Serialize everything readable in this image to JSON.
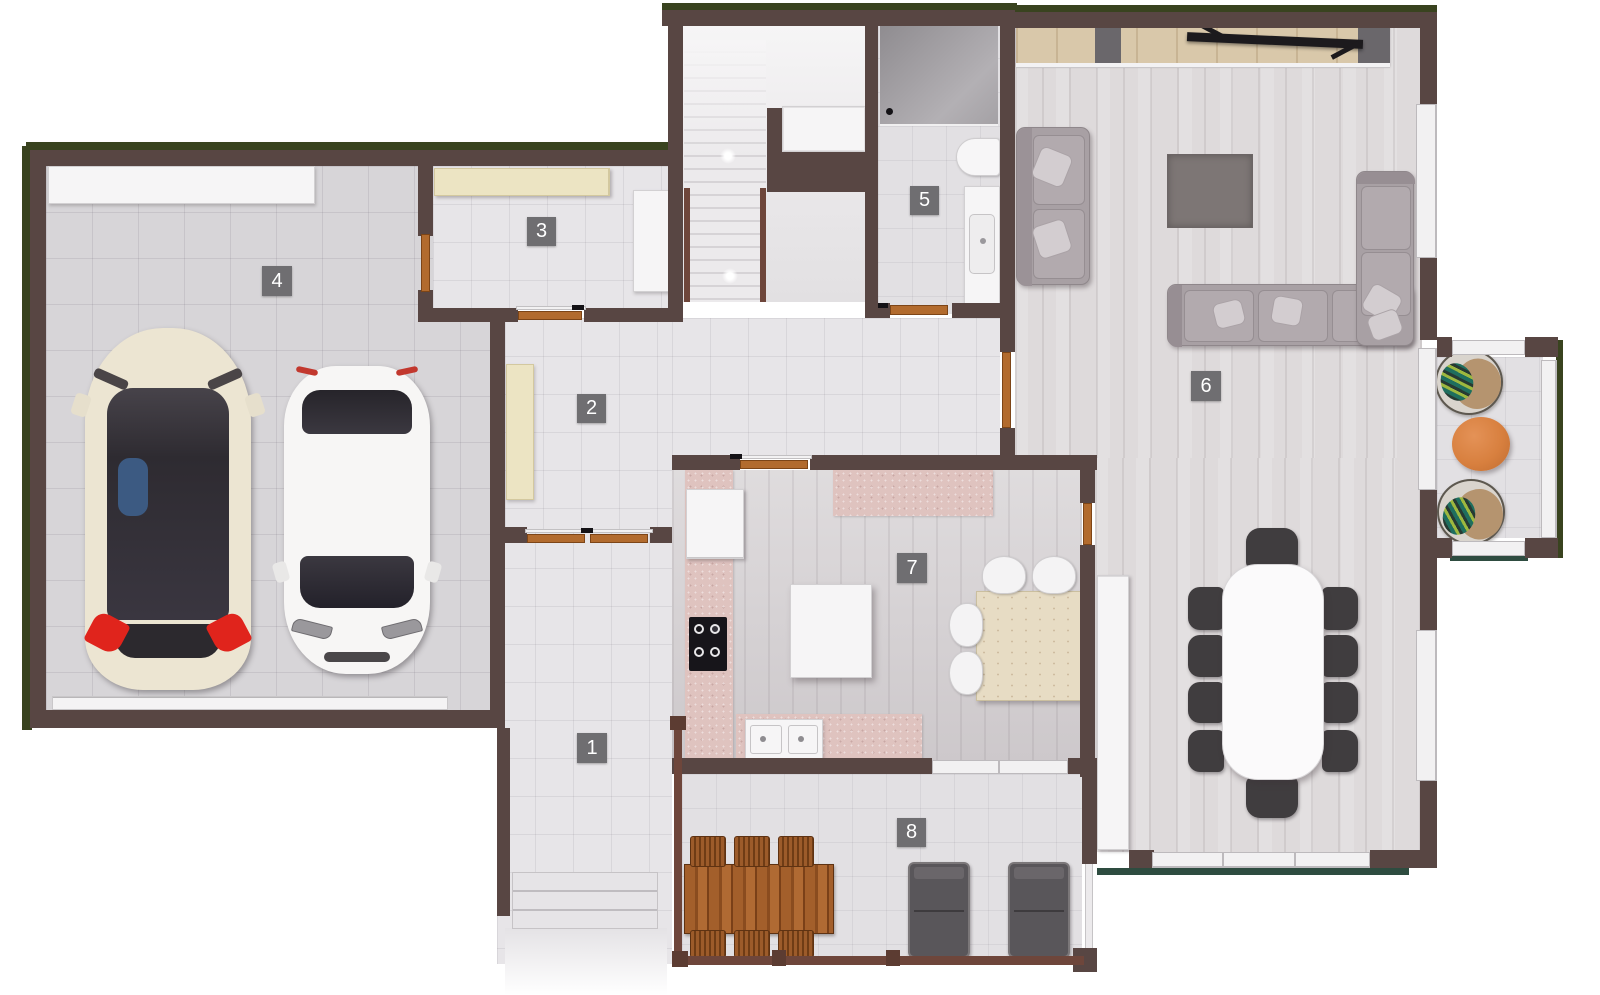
{
  "rooms": [
    {
      "label": "1"
    },
    {
      "label": "2"
    },
    {
      "label": "3"
    },
    {
      "label": "4"
    },
    {
      "label": "5"
    },
    {
      "label": "6"
    },
    {
      "label": "7"
    },
    {
      "label": "8"
    }
  ],
  "palette": {
    "wall": "#584643",
    "grass": "#39431f",
    "door_wood": "#b26b2e",
    "badge_bg": "#6f6e71",
    "badge_text": "#ffffff",
    "floor_tile": "#e7e5e8",
    "garage_floor": "#d7d5d8",
    "living_wood_floor": "#dedadb",
    "kitchen_floor": "#d6d2d4",
    "counter_pink": "#dfc3bf",
    "cabinet_beige": "#ece4c3",
    "cabinet_white": "#f6f5f6",
    "sideboard_wood": "#d9c8aa",
    "sofa_gray": "#a8a0a4",
    "rug_gray": "#7d7675",
    "dining_chair_dark": "#403d3f",
    "outdoor_table_wood": "#a35f2b",
    "balcony_table_orange": "#d8803f",
    "railing_maroon": "#6e463b",
    "car_cream": "#ece5d2",
    "car_white": "#f7f6f5",
    "car_taillight_red": "#e0241c"
  }
}
